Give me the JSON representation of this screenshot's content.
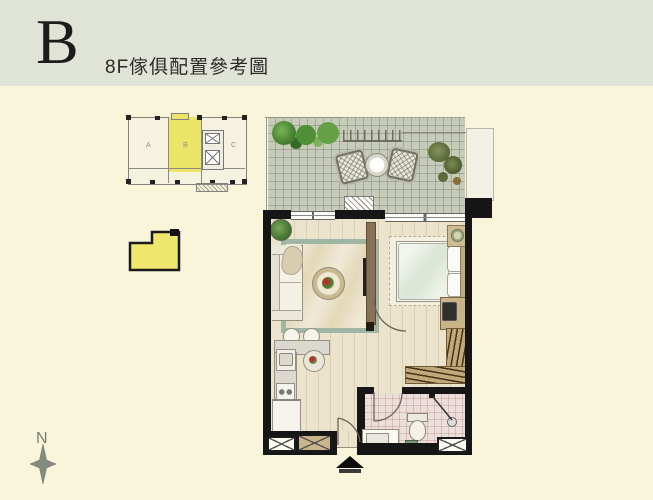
{
  "header": {
    "unit_letter": "B",
    "subtitle": "8F傢俱配置參考圖"
  },
  "keyplan": {
    "unit_labels": [
      "A",
      "B",
      "C"
    ],
    "highlighted_unit": "B"
  },
  "compass": {
    "label": "N"
  },
  "colors": {
    "background": "#f8f5da",
    "header_band": "#e0e4d6",
    "ink": "#1c1c1c",
    "wall": "#161616",
    "unit_yellow": "#efe66e",
    "keyplan_yellow": "#ece468",
    "terrace_tile": "#c7ccba",
    "indoor_floor": "#ebe3cc",
    "bathroom_floor": "#ecdeda",
    "rug_border": "#9fb6a5",
    "rug_fill": "#e4d8b8",
    "wood": "#8a7257",
    "wardrobe": "#c2a878",
    "plant_green": "#5d8f46",
    "compass_gray": "#868b7e"
  }
}
